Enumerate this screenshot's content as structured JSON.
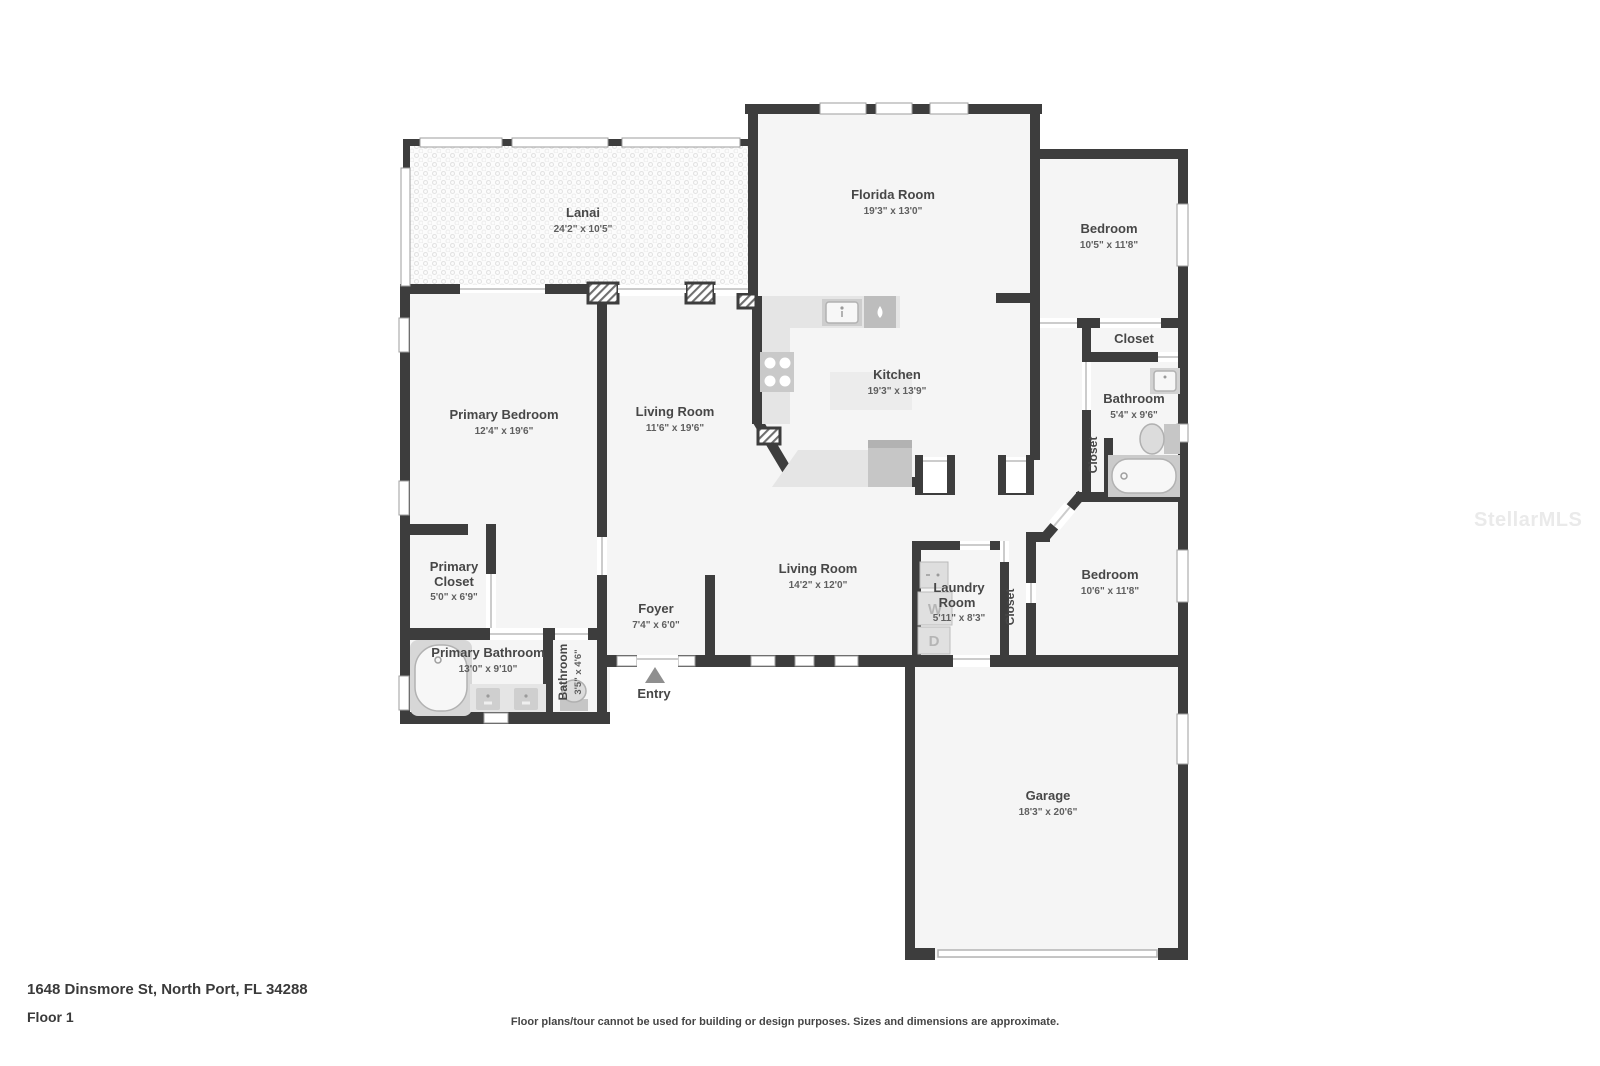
{
  "floorplan": {
    "rooms": {
      "lanai": {
        "name": "Lanai",
        "dims": "24'2\" x 10'5\""
      },
      "florida_room": {
        "name": "Florida Room",
        "dims": "19'3\" x 13'0\""
      },
      "kitchen": {
        "name": "Kitchen",
        "dims": "19'3\" x 13'9\""
      },
      "primary_bedroom": {
        "name": "Primary Bedroom",
        "dims": "12'4\" x 19'6\""
      },
      "living_room_upper": {
        "name": "Living Room",
        "dims": "11'6\" x 19'6\""
      },
      "living_room_lower": {
        "name": "Living Room",
        "dims": "14'2\" x 12'0\""
      },
      "foyer": {
        "name": "Foyer",
        "dims": "7'4\" x 6'0\""
      },
      "entry": {
        "name": "Entry"
      },
      "primary_closet": {
        "name_line1": "Primary",
        "name_line2": "Closet",
        "dims": "5'0\" x 6'9\""
      },
      "primary_bathroom": {
        "name": "Primary Bathroom",
        "dims": "13'0\" x 9'10\""
      },
      "bathroom_small": {
        "name": "Bathroom",
        "dims": "3'5\" x 4'6\""
      },
      "bedroom_top": {
        "name": "Bedroom",
        "dims": "10'5\" x 11'8\""
      },
      "closet_top": {
        "name": "Closet"
      },
      "bathroom_right": {
        "name": "Bathroom",
        "dims": "5'4\" x 9'6\""
      },
      "closet_bathroom": {
        "name": "Closet"
      },
      "laundry": {
        "name_line1": "Laundry",
        "name_line2": "Room",
        "dims": "5'11\" x 8'3\""
      },
      "closet_hall": {
        "name": "Closet"
      },
      "bedroom_right": {
        "name": "Bedroom",
        "dims": "10'6\" x 11'8\""
      },
      "garage": {
        "name": "Garage",
        "dims": "18'3\" x 20'6\""
      }
    },
    "appliances": {
      "washer_label": "W",
      "dryer_label": "D"
    },
    "footer": {
      "address": "1648 Dinsmore St, North Port, FL 34288",
      "floor_label": "Floor 1",
      "disclaimer": "Floor plans/tour cannot be used for building or design purposes. Sizes and dimensions are approximate."
    },
    "watermark": "StellarMLS",
    "colors": {
      "wall": "#3d3d3d",
      "room_fill": "#f5f5f5",
      "counter": "#e5e5e5",
      "appliance": "#c7c7c7"
    }
  }
}
